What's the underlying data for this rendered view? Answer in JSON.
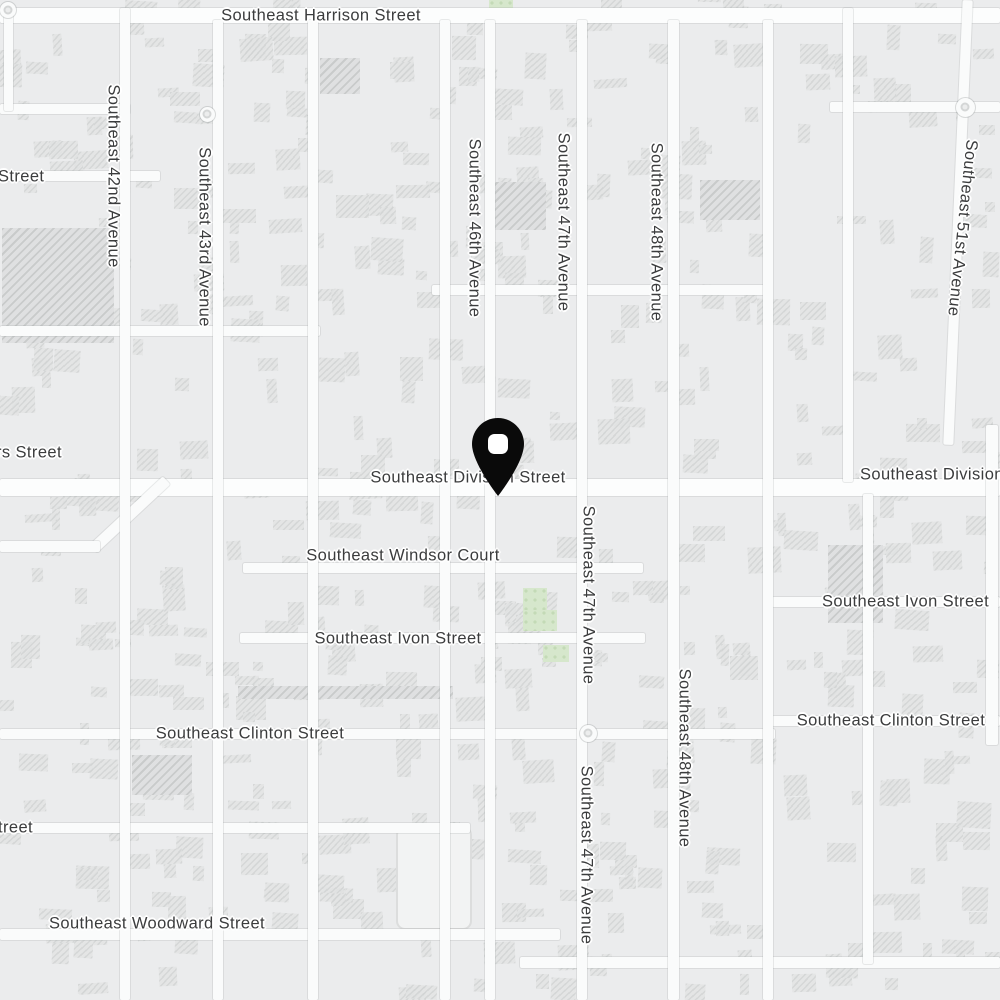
{
  "map": {
    "colors": {
      "background": "#ebeced",
      "road": "#fafbfb",
      "building_fill": "#e3e4e4",
      "building_hatch": "#d2d4d4",
      "green_area": "#d6e7cc",
      "label_text": "#3b3c3d",
      "label_halo": "#ffffff",
      "pin": "#0a0a0a",
      "pin_hole": "#ffffff"
    },
    "labels": [
      {
        "id": "harrison",
        "text": "Southeast Harrison Street",
        "x": 321,
        "y": 16,
        "rot": 0,
        "anchor": "center"
      },
      {
        "id": "lincoln-partial",
        "text": "Street",
        "x": -2,
        "y": 177,
        "rot": 0,
        "anchor": "left"
      },
      {
        "id": "se-42nd-avenue",
        "text": "Southeast 42nd Avenue",
        "x": 113,
        "y": 176,
        "rot": 90,
        "anchor": "center"
      },
      {
        "id": "se-43rd-avenue",
        "text": "Southeast 43rd Avenue",
        "x": 204,
        "y": 237,
        "rot": 90,
        "anchor": "center"
      },
      {
        "id": "se-46th-avenue",
        "text": "Southeast 46th Avenue",
        "x": 474,
        "y": 228,
        "rot": 90,
        "anchor": "center"
      },
      {
        "id": "se-47th-avenue-north",
        "text": "Southeast 47th Avenue",
        "x": 563,
        "y": 222,
        "rot": 90,
        "anchor": "center"
      },
      {
        "id": "se-48th-avenue-north",
        "text": "Southeast 48th Avenue",
        "x": 656,
        "y": 232,
        "rot": 90,
        "anchor": "center"
      },
      {
        "id": "se-51st-avenue",
        "text": "Southeast 51st Avenue",
        "x": 962,
        "y": 228,
        "rot": 96,
        "anchor": "center"
      },
      {
        "id": "caruthers-partial",
        "text": "rs Street",
        "x": -4,
        "y": 453,
        "rot": 0,
        "anchor": "left"
      },
      {
        "id": "division-center",
        "text": "Southeast Division Street",
        "x": 468,
        "y": 478,
        "rot": 0,
        "anchor": "center"
      },
      {
        "id": "division-right",
        "text": "Southeast Division Street",
        "x": 860,
        "y": 475,
        "rot": 0,
        "anchor": "left"
      },
      {
        "id": "windsor-court",
        "text": "Southeast Windsor Court",
        "x": 403,
        "y": 556,
        "rot": 0,
        "anchor": "center"
      },
      {
        "id": "ivon-center",
        "text": "Southeast Ivon Street",
        "x": 398,
        "y": 639,
        "rot": 0,
        "anchor": "center"
      },
      {
        "id": "ivon-right",
        "text": "Southeast Ivon Street",
        "x": 822,
        "y": 602,
        "rot": 0,
        "anchor": "left"
      },
      {
        "id": "se-47th-avenue-mid",
        "text": "Southeast 47th Avenue",
        "x": 588,
        "y": 595,
        "rot": 90,
        "anchor": "center"
      },
      {
        "id": "clinton-west",
        "text": "Southeast Clinton Street",
        "x": 250,
        "y": 734,
        "rot": 0,
        "anchor": "center"
      },
      {
        "id": "clinton-east",
        "text": "Southeast Clinton Street",
        "x": 891,
        "y": 721,
        "rot": 0,
        "anchor": "center"
      },
      {
        "id": "se-48th-avenue-south",
        "text": "Southeast 48th Avenue",
        "x": 684,
        "y": 758,
        "rot": 90,
        "anchor": "center"
      },
      {
        "id": "se-47th-avenue-south",
        "text": "Southeast 47th Avenue",
        "x": 586,
        "y": 855,
        "rot": 90,
        "anchor": "center"
      },
      {
        "id": "taggart-partial",
        "text": "treet",
        "x": -2,
        "y": 828,
        "rot": 0,
        "anchor": "left"
      },
      {
        "id": "woodward",
        "text": "Southeast Woodward Street",
        "x": 157,
        "y": 924,
        "rot": 0,
        "anchor": "center"
      }
    ],
    "roads": [
      {
        "x": 0,
        "y": 8,
        "w": 1000,
        "h": 15,
        "major": true
      },
      {
        "x": 0,
        "y": 104,
        "w": 130,
        "h": 10
      },
      {
        "x": 830,
        "y": 102,
        "w": 170,
        "h": 10
      },
      {
        "x": 0,
        "y": 171,
        "w": 160,
        "h": 10
      },
      {
        "x": 432,
        "y": 285,
        "w": 340,
        "h": 10
      },
      {
        "x": 0,
        "y": 326,
        "w": 320,
        "h": 10
      },
      {
        "x": 0,
        "y": 479,
        "w": 1000,
        "h": 17,
        "major": true
      },
      {
        "x": 80,
        "y": 509,
        "w": 100,
        "h": 11,
        "rot": 137
      },
      {
        "x": 0,
        "y": 541,
        "w": 100,
        "h": 11
      },
      {
        "x": 243,
        "y": 563,
        "w": 400,
        "h": 10
      },
      {
        "x": 240,
        "y": 633,
        "w": 405,
        "h": 10
      },
      {
        "x": 772,
        "y": 597,
        "w": 228,
        "h": 10
      },
      {
        "x": 0,
        "y": 729,
        "w": 775,
        "h": 10
      },
      {
        "x": 772,
        "y": 716,
        "w": 228,
        "h": 10
      },
      {
        "x": 0,
        "y": 823,
        "w": 470,
        "h": 10
      },
      {
        "x": 0,
        "y": 929,
        "w": 560,
        "h": 11
      },
      {
        "x": 520,
        "y": 957,
        "w": 480,
        "h": 11
      },
      {
        "x": 4,
        "y": 8,
        "w": 9,
        "h": 103
      },
      {
        "x": 120,
        "y": 8,
        "w": 10,
        "h": 992
      },
      {
        "x": 213,
        "y": 20,
        "w": 10,
        "h": 980
      },
      {
        "x": 308,
        "y": 20,
        "w": 10,
        "h": 980
      },
      {
        "x": 440,
        "y": 20,
        "w": 10,
        "h": 980
      },
      {
        "x": 485,
        "y": 20,
        "w": 10,
        "h": 980
      },
      {
        "x": 577,
        "y": 20,
        "w": 10,
        "h": 980
      },
      {
        "x": 668,
        "y": 20,
        "w": 11,
        "h": 980
      },
      {
        "x": 763,
        "y": 20,
        "w": 10,
        "h": 980
      },
      {
        "x": 843,
        "y": 8,
        "w": 10,
        "h": 474
      },
      {
        "x": 863,
        "y": 494,
        "w": 10,
        "h": 470
      },
      {
        "x": 986,
        "y": 425,
        "w": 12,
        "h": 320
      },
      {
        "x": 953,
        "y": 0,
        "w": 10,
        "h": 445,
        "rot": 2.5
      }
    ],
    "traffic_circles": [
      {
        "x": 8,
        "y": 10,
        "d": 16
      },
      {
        "x": 207,
        "y": 114,
        "d": 15
      },
      {
        "x": 588,
        "y": 733,
        "d": 17
      },
      {
        "x": 965,
        "y": 107,
        "d": 19
      }
    ],
    "green_areas": [
      {
        "x": 523,
        "y": 588,
        "w": 24,
        "h": 26
      },
      {
        "x": 523,
        "y": 610,
        "w": 34,
        "h": 21
      },
      {
        "x": 543,
        "y": 645,
        "w": 26,
        "h": 17
      },
      {
        "x": 489,
        "y": 0,
        "w": 24,
        "h": 12
      }
    ],
    "large_buildings": [
      {
        "x": 2,
        "y": 228,
        "w": 112,
        "h": 115
      },
      {
        "x": 488,
        "y": 182,
        "w": 58,
        "h": 48
      },
      {
        "x": 700,
        "y": 180,
        "w": 60,
        "h": 40
      },
      {
        "x": 320,
        "y": 58,
        "w": 40,
        "h": 36
      },
      {
        "x": 132,
        "y": 755,
        "w": 60,
        "h": 40
      },
      {
        "x": 828,
        "y": 545,
        "w": 55,
        "h": 78
      },
      {
        "x": 238,
        "y": 686,
        "w": 215,
        "h": 13
      }
    ],
    "outlined_lot": {
      "x": 396,
      "y": 826,
      "w": 72,
      "h": 100
    },
    "pin": {
      "tip_x": 498,
      "tip_y": 496,
      "head_x": 498,
      "head_y": 446,
      "description": "black map pin with white hole"
    }
  }
}
